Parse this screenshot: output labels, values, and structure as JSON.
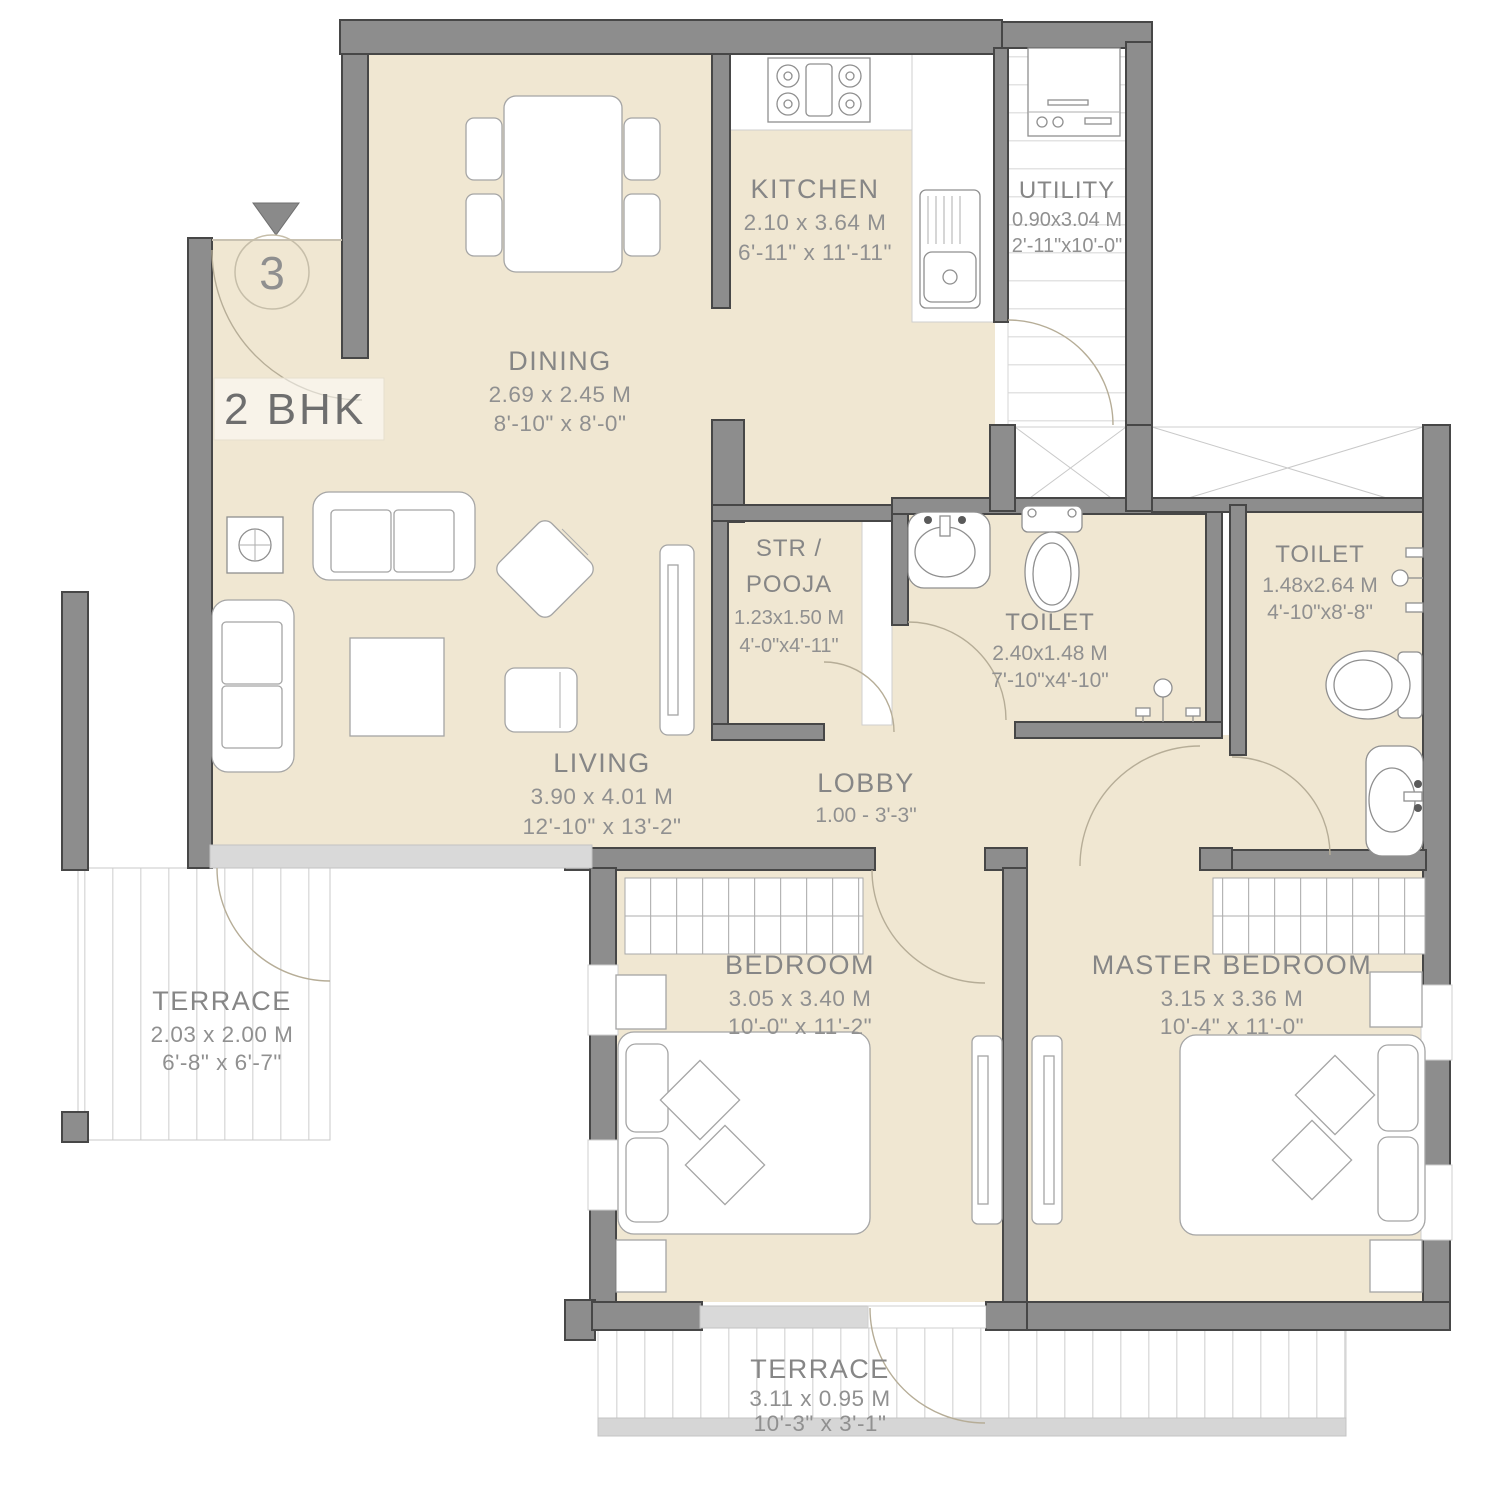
{
  "plan": {
    "unit_label": "2 BHK",
    "entry_number": "3",
    "rooms": [
      {
        "key": "dining",
        "name": "DINING",
        "metric": "2.69 x 2.45 M",
        "imperial": "8'-10\" x 8'-0\""
      },
      {
        "key": "kitchen",
        "name": "KITCHEN",
        "metric": "2.10 x 3.64 M",
        "imperial": "6'-11\" x 11'-11\""
      },
      {
        "key": "utility",
        "name": "UTILITY",
        "metric": "0.90x3.04 M",
        "imperial": "2'-11\"x10'-0\""
      },
      {
        "key": "str_pooja",
        "name_line1": "STR /",
        "name_line2": "POOJA",
        "metric": "1.23x1.50 M",
        "imperial": "4'-0\"x4'-11\""
      },
      {
        "key": "toilet_common",
        "name": "TOILET",
        "metric": "2.40x1.48 M",
        "imperial": "7'-10\"x4'-10\""
      },
      {
        "key": "toilet_master",
        "name": "TOILET",
        "metric": "1.48x2.64 M",
        "imperial": "4'-10\"x8'-8\""
      },
      {
        "key": "living",
        "name": "LIVING",
        "metric": "3.90 x 4.01 M",
        "imperial": "12'-10\" x 13'-2\""
      },
      {
        "key": "lobby",
        "name": "LOBBY",
        "metric": "1.00 - 3'-3\""
      },
      {
        "key": "terrace_left",
        "name": "TERRACE",
        "metric": "2.03 x 2.00 M",
        "imperial": "6'-8\" x 6'-7\""
      },
      {
        "key": "bedroom",
        "name": "BEDROOM",
        "metric": "3.05 x 3.40 M",
        "imperial": "10'-0\" x 11'-2\""
      },
      {
        "key": "master_bedroom",
        "name": "MASTER BEDROOM",
        "metric": "3.15 x 3.36 M",
        "imperial": "10'-4\" x 11'-0\""
      },
      {
        "key": "terrace_bottom",
        "name": "TERRACE",
        "metric": "3.11 x 0.95 M",
        "imperial": "10'-3\" x 3'-1\""
      }
    ],
    "colors": {
      "floor": "#f0e7d2",
      "wall": "#8d8d8d",
      "wall_outline": "#474747",
      "stripe": "#dedede",
      "label_text": "#868686"
    }
  }
}
